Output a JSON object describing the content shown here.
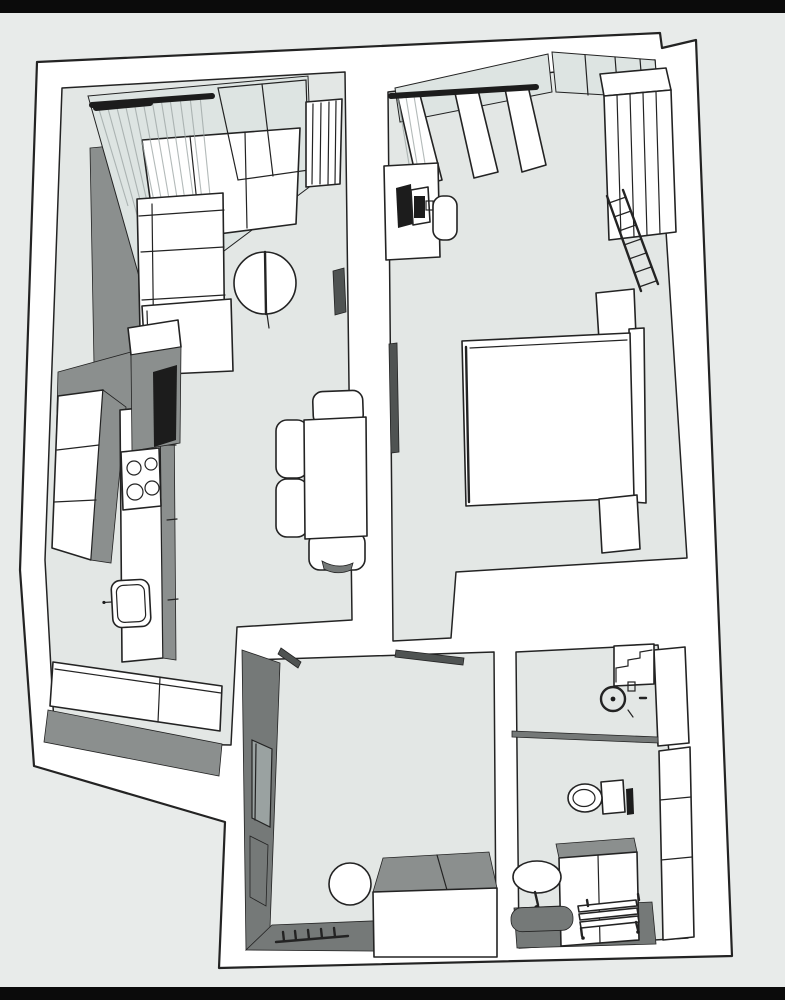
{
  "meta": {
    "type": "floor-plan-3d-render",
    "view": "top-down-axonometric",
    "title": ""
  },
  "colors": {
    "page-bg": "#e8ebea",
    "letterbox": "#0b0b0b",
    "outline": "#232323",
    "wall": "#ffffff",
    "wall-shadow": "#8b8f8e",
    "wall-shadow-dark": "#757978",
    "floor": "#e3e7e5",
    "glass": "#dde4e2",
    "mirror": "#9aa2a1",
    "appliance-dark": "#1c1c1c",
    "door-leaf": "#4f5352"
  },
  "rooms": [
    {
      "name": "living-room-kitchen",
      "furniture": [
        "window-with-curtains",
        "radiator",
        "sectional-sofa",
        "round-side-table",
        "dining-table",
        "dining-chairs",
        "sideboard",
        "tall-kitchen-unit",
        "cooktop-4-burners",
        "kitchen-island",
        "kitchen-counter",
        "kitchen-sink",
        "door-leaf"
      ]
    },
    {
      "name": "bedroom",
      "furniture": [
        "window-with-curtains",
        "desk",
        "laptop",
        "desk-chair",
        "sliding-wardrobe",
        "ladder-rack",
        "double-bed",
        "headboard",
        "nightstand-top",
        "nightstand-bottom",
        "door-leaf"
      ]
    },
    {
      "name": "entry-hall",
      "furniture": [
        "leaning-mirror",
        "wall-panel",
        "coat-rack-5-hooks",
        "round-pouf",
        "shoe-cabinet",
        "open-door-leaves"
      ]
    },
    {
      "name": "bathroom",
      "furniture": [
        "shower-area",
        "shower-head",
        "shelf-steps",
        "glass-partition",
        "toilet",
        "cistern",
        "towel-radiator",
        "vanity-counter",
        "wash-basin",
        "faucet",
        "bath-mat",
        "drying-rack",
        "wall-cabinets"
      ]
    }
  ]
}
